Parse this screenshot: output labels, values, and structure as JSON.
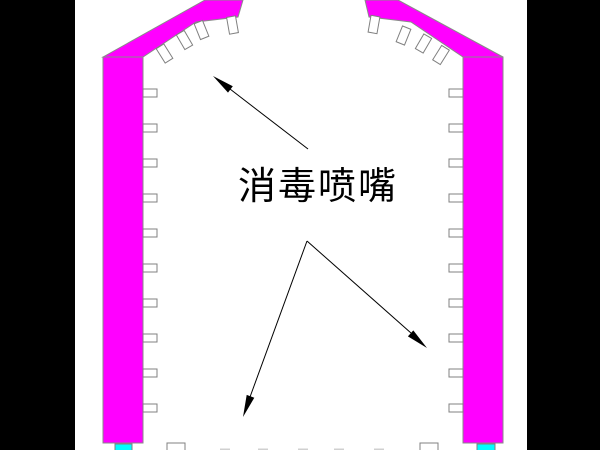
{
  "diagram": {
    "label": "消毒喷嘴",
    "label_meaning": "disinfection nozzle",
    "colors": {
      "wall": "#ff00ff",
      "wall_outline": "#8a8a8a",
      "nozzle_fill": "#ffffff",
      "nozzle_outline": "#808080",
      "base_pad": "#00ffff",
      "letterbox": "#000000",
      "background": "#ffffff",
      "arrow": "#000000",
      "label_color": "#000000"
    },
    "counts": {
      "left_wall_nozzles": 10,
      "right_wall_nozzles": 10,
      "left_roof_nozzles": 4,
      "right_roof_nozzles": 4,
      "leader_arrows": 3
    }
  }
}
